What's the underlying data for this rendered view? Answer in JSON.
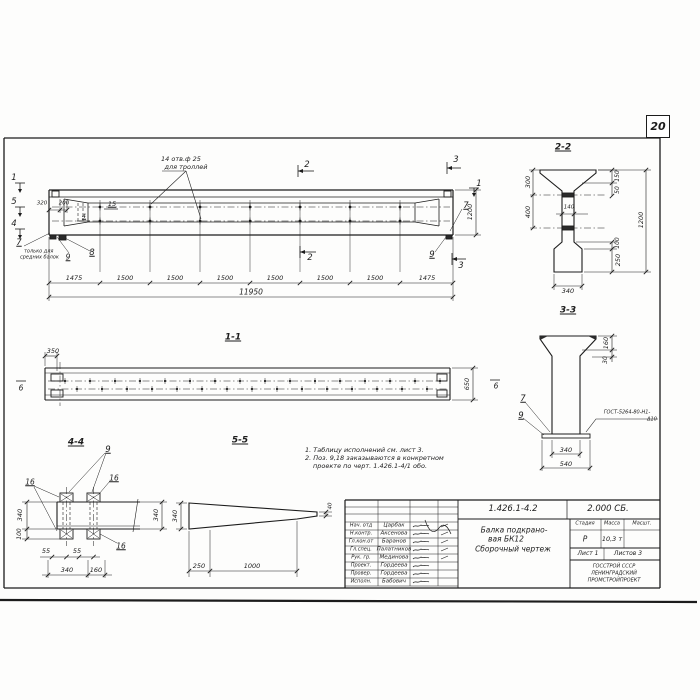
{
  "sheet": {
    "page_number": "20"
  },
  "main_view": {
    "callout_line1": "14 отв.ф 25",
    "callout_line2": "для троллей",
    "mark_1": "1",
    "mark_2": "2",
    "mark_3": "3",
    "mark_4": "4",
    "mark_5": "5",
    "mark_4b": "4",
    "dim_320": "320",
    "dim_200": "200",
    "pos_15": "15",
    "pos_7": "7",
    "pos_8": "8",
    "pos_9": "9",
    "note_line1": "только для",
    "note_line2": "средних балок",
    "dims_bottom": [
      "1475",
      "1500",
      "1500",
      "1500",
      "1500",
      "1500",
      "1500",
      "1475"
    ],
    "dim_total": "11950",
    "dim_height": "1200"
  },
  "section_1_1": {
    "title": "1-1",
    "dim_350": "350",
    "dim_650": "650",
    "mark_6": "6"
  },
  "section_2_2": {
    "title": "2-2",
    "dim_300": "300",
    "dim_400": "400",
    "dim_150": "150",
    "dim_50": "50",
    "dim_140": "140",
    "dim_1200": "1200",
    "dim_100": "100",
    "dim_250": "250",
    "dim_340": "340"
  },
  "section_3_3": {
    "title": "3-3",
    "dim_160": "160",
    "dim_30": "30",
    "pos_7": "7",
    "pos_9": "9",
    "weld_line1": "ГОСТ-5264-80-Н1-",
    "weld_line2": "Δ10",
    "dim_340": "340",
    "dim_540": "540"
  },
  "section_4_4": {
    "title": "4-4",
    "pos_9": "9",
    "pos_16": "16",
    "dim_340_left": "340",
    "dim_100": "100",
    "dim_340_right": "340",
    "dim_55": "55",
    "dim_340_bottom": "340",
    "dim_160": "160"
  },
  "section_5_5": {
    "title": "5-5",
    "dim_340": "340",
    "dim_250": "250",
    "dim_1000": "1000",
    "dim_40": "40"
  },
  "notes": {
    "line1": "1. Таблицу исполнений см. лист 3.",
    "line2": "2. Поз. 9,18 заказываются в конкретном",
    "line3": "проекте по черт. 1.426.1-4/1 обо."
  },
  "title_block": {
    "doc_number": "1.426.1-4.2",
    "doc_code": "2.000 СБ.",
    "rows": [
      {
        "role": "Нач. отд",
        "name": "Царбак"
      },
      {
        "role": "Н.контр.",
        "name": "Аксенова"
      },
      {
        "role": "Гл.кон.от",
        "name": "Баранов"
      },
      {
        "role": "Гл.спец.",
        "name": "Палатников"
      },
      {
        "role": "Рук. гр.",
        "name": "Мединова"
      },
      {
        "role": "Проект.",
        "name": "Гордеева"
      },
      {
        "role": "Провер.",
        "name": "Гордеева"
      },
      {
        "role": "Исполн.",
        "name": "Бабович"
      }
    ],
    "title_line1": "Балка подкрано-",
    "title_line2": "вая БК12",
    "title_line3": "Сборочный чертеж",
    "stage_header": "Стадия",
    "mass_header": "Масса",
    "scale_header": "Масшт.",
    "stage_value": "Р",
    "mass_value": "10,3 т",
    "scale_value": "",
    "sheet_info": "Лист 1",
    "sheets_info": "Листов 3",
    "org_line1": "ГОССТРОЙ СССР",
    "org_line2": "ЛЕНИНГРАДСКИЙ",
    "org_line3": "ПРОМСТРОЙПРОЕКТ"
  }
}
